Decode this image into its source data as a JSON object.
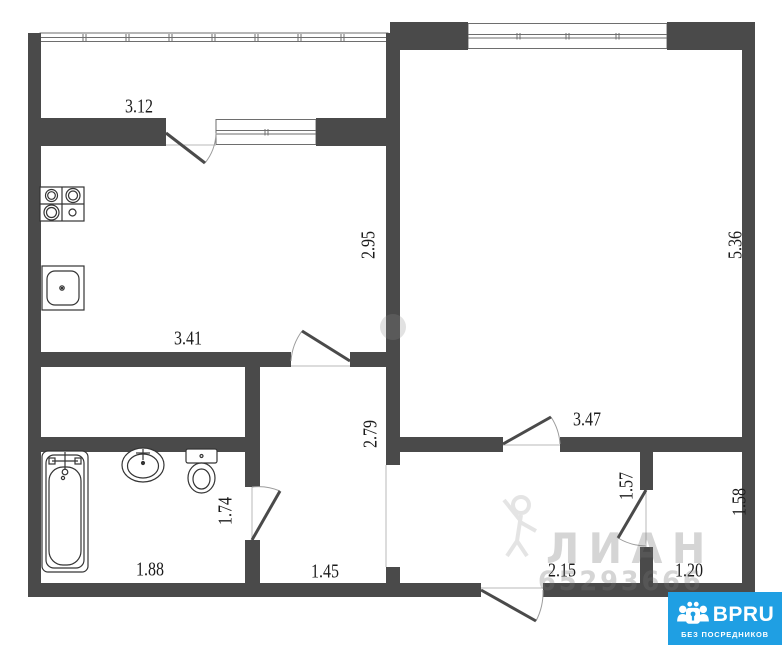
{
  "plan": {
    "dimensions": {
      "balcony_width": "3.12",
      "kitchen_width": "3.41",
      "kitchen_height": "2.95",
      "living_width": "3.47",
      "living_height": "5.36",
      "hall_height": "2.79",
      "hall_width": "1.45",
      "bathroom_width": "1.88",
      "bathroom_height": "1.74",
      "entry_width": "2.15",
      "closet_height": "1.57",
      "storage_width": "1.20",
      "storage_height": "1.58"
    },
    "icons": {
      "stove": "stove-icon",
      "kitchen_sink": "kitchen-sink-icon",
      "bathtub": "bathtub-icon",
      "washbasin": "washbasin-icon",
      "toilet": "toilet-icon",
      "logo_mark": "people-lock-icon"
    },
    "colors": {
      "wall": "#4a4a4a",
      "logo_blue": "#1f9fe3"
    }
  },
  "watermark": {
    "agency": "ЛИАН",
    "phone": "65293666"
  },
  "logo": {
    "brand": "BPRU",
    "tagline": "БЕЗ ПОСРЕДНИКОВ"
  }
}
